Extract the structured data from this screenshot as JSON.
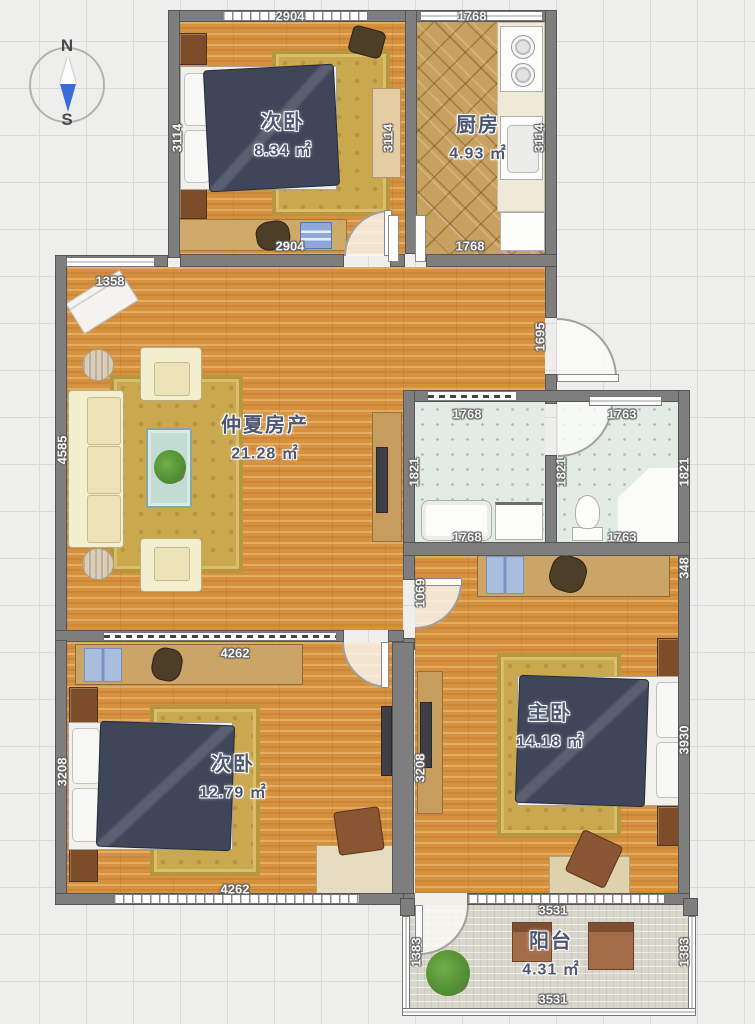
{
  "compass": {
    "north": "N",
    "south": "S"
  },
  "rooms": {
    "bedroom_top": {
      "name": "次卧",
      "area": "8.34 ㎡"
    },
    "kitchen": {
      "name": "厨房",
      "area": "4.93 ㎡"
    },
    "living": {
      "name": "仲夏房产",
      "area": "21.28 ㎡"
    },
    "bedroom_left": {
      "name": "次卧",
      "area": "12.79 ㎡"
    },
    "bedroom_master": {
      "name": "主卧",
      "area": "14.18 ㎡"
    },
    "balcony": {
      "name": "阳台",
      "area": "4.31 ㎡"
    }
  },
  "dimensions": [
    {
      "text": "2904",
      "x": 290,
      "y": 16,
      "o": "h"
    },
    {
      "text": "1768",
      "x": 472,
      "y": 16,
      "o": "h"
    },
    {
      "text": "3114",
      "x": 177,
      "y": 138,
      "o": "v"
    },
    {
      "text": "3114",
      "x": 388,
      "y": 138,
      "o": "v"
    },
    {
      "text": "3114",
      "x": 539,
      "y": 138,
      "o": "v"
    },
    {
      "text": "2904",
      "x": 290,
      "y": 246,
      "o": "h"
    },
    {
      "text": "1768",
      "x": 470,
      "y": 246,
      "o": "h"
    },
    {
      "text": "1358",
      "x": 110,
      "y": 281,
      "o": "h"
    },
    {
      "text": "1695",
      "x": 540,
      "y": 337,
      "o": "v"
    },
    {
      "text": "4585",
      "x": 62,
      "y": 450,
      "o": "v"
    },
    {
      "text": "1768",
      "x": 467,
      "y": 414,
      "o": "h"
    },
    {
      "text": "1763",
      "x": 622,
      "y": 414,
      "o": "h"
    },
    {
      "text": "1821",
      "x": 414,
      "y": 472,
      "o": "v"
    },
    {
      "text": "1821",
      "x": 561,
      "y": 472,
      "o": "v"
    },
    {
      "text": "1821",
      "x": 684,
      "y": 472,
      "o": "v"
    },
    {
      "text": "1768",
      "x": 467,
      "y": 537,
      "o": "h"
    },
    {
      "text": "1763",
      "x": 622,
      "y": 537,
      "o": "h"
    },
    {
      "text": "348",
      "x": 684,
      "y": 568,
      "o": "v"
    },
    {
      "text": "1069",
      "x": 420,
      "y": 593,
      "o": "v"
    },
    {
      "text": "4262",
      "x": 235,
      "y": 653,
      "o": "h"
    },
    {
      "text": "3208",
      "x": 62,
      "y": 772,
      "o": "v"
    },
    {
      "text": "3208",
      "x": 420,
      "y": 768,
      "o": "v"
    },
    {
      "text": "3930",
      "x": 684,
      "y": 740,
      "o": "v"
    },
    {
      "text": "4262",
      "x": 235,
      "y": 889,
      "o": "h"
    },
    {
      "text": "3531",
      "x": 553,
      "y": 910,
      "o": "h"
    },
    {
      "text": "1383",
      "x": 416,
      "y": 952,
      "o": "v"
    },
    {
      "text": "1383",
      "x": 684,
      "y": 952,
      "o": "v"
    },
    {
      "text": "3531",
      "x": 553,
      "y": 999,
      "o": "h"
    }
  ]
}
